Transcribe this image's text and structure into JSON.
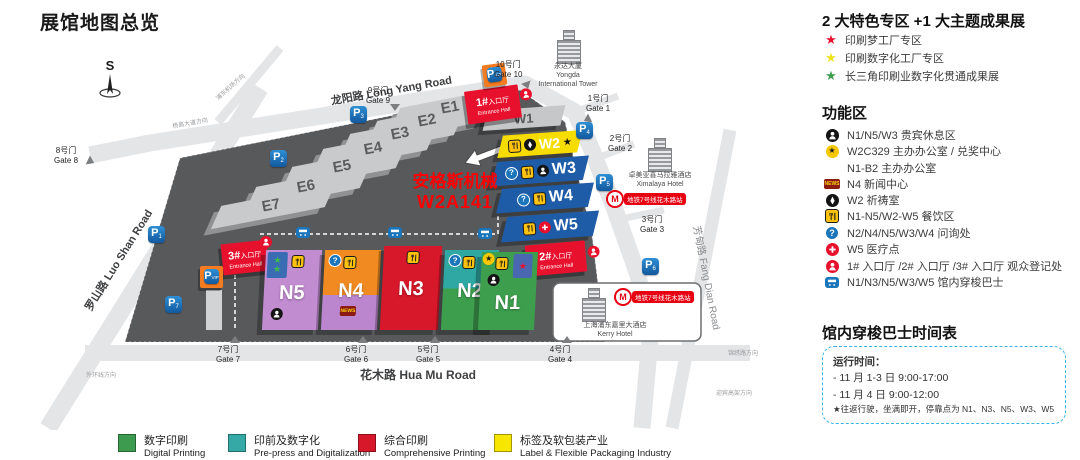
{
  "page_title": "展馆地图总览",
  "icons": {
    "news_text": "NEWS",
    "star_glyph": "★",
    "question_glyph": "?"
  },
  "colors": {
    "digital_green": "#3D9B4F",
    "prepress_teal": "#35A9A5",
    "comprehensive_red": "#D7182A",
    "label_yellow": "#F7E600",
    "entrance_red": "#E8112D",
    "w_hall_blue": "#1E5CA8",
    "w2_yellow": "#F7DC00",
    "n5_purple": "#C18CD0",
    "n4_orange": "#F08A21",
    "highlight_red": "#FF0000",
    "parking_blue": "#1B75BB",
    "vip_orange": "#F47B20",
    "metro_red": "#E60012"
  },
  "map": {
    "compass": "S",
    "roads": {
      "long_yang": "龙阳路 Long Yang Road",
      "luo_shan": "罗山路 Luo Shan Road",
      "hua_mu": "花木路 Hua Mu Road",
      "fang_dian": "芳甸路 Fang Dian Road"
    },
    "directions": {
      "airport": "浦东机场方向",
      "yanggao": "杨高大道方向",
      "waihuan": "外环线方向",
      "jinxiu": "锦绣路方向",
      "yingbin": "迎宾高架方向"
    },
    "halls": {
      "e": [
        "E1",
        "E2",
        "E3",
        "E4",
        "E5",
        "E6",
        "E7"
      ],
      "w": [
        "W1",
        "W2",
        "W3",
        "W4",
        "W5"
      ],
      "n": [
        "N5",
        "N4",
        "N3",
        "N2",
        "N1"
      ]
    },
    "entrances": [
      {
        "no": "1#",
        "cn": "入口厅",
        "en": "Entrance Hall"
      },
      {
        "no": "2#",
        "cn": "入口厅",
        "en": "Entrance Hall"
      },
      {
        "no": "3#",
        "cn": "入口厅",
        "en": "Entrance Hall"
      }
    ],
    "gates": [
      {
        "cn": "1号门",
        "en": "Gate 1"
      },
      {
        "cn": "2号门",
        "en": "Gate 2"
      },
      {
        "cn": "3号门",
        "en": "Gate 3"
      },
      {
        "cn": "4号门",
        "en": "Gate 4"
      },
      {
        "cn": "5号门",
        "en": "Gate 5"
      },
      {
        "cn": "6号门",
        "en": "Gate 6"
      },
      {
        "cn": "7号门",
        "en": "Gate 7"
      },
      {
        "cn": "8号门",
        "en": "Gate 8"
      },
      {
        "cn": "9号门",
        "en": "Gate 9"
      },
      {
        "cn": "10号门",
        "en": "Gate 10"
      }
    ],
    "parking": {
      "p": "P",
      "vip": "VIP",
      "nums": [
        "1",
        "2",
        "3",
        "4",
        "5",
        "6",
        "7"
      ]
    },
    "buildings": {
      "yongda_cn": "永达大厦",
      "yongda_en1": "Yongda",
      "yongda_en2": "International Tower",
      "ximalaya_cn": "卓美亚喜马拉雅酒店",
      "ximalaya_en": "Ximalaya Hotel",
      "kerry_cn": "上海浦东嘉里大酒店",
      "kerry_en": "Kerry Hotel"
    },
    "metro_label": "地铁7号线花木路站",
    "metro_logo": "M",
    "callout": {
      "line1": "安格斯机械",
      "line2": "W2A141"
    }
  },
  "panel": {
    "special_title": "2 大特色专区 +1 大主题成果展",
    "special_items": [
      {
        "color": "#E8112D",
        "label": "印刷梦工厂专区"
      },
      {
        "color": "#EDE21B",
        "label": "印刷数字化工厂专区"
      },
      {
        "color": "#3D9B4F",
        "label": "长三角印刷业数字化贯通成果展"
      }
    ],
    "function_title": "功能区",
    "function_items": [
      {
        "icon": "person",
        "label": "N1/N5/W3 贵宾休息区"
      },
      {
        "icon": "star",
        "label": "W2C329 主办办公室 / 兑奖中心"
      },
      {
        "icon": "none",
        "label": "N1-B2 主办办公室"
      },
      {
        "icon": "news",
        "label": "N4 新闻中心"
      },
      {
        "icon": "prayer",
        "label": "W2 祈祷室"
      },
      {
        "icon": "food",
        "label": "N1-N5/W2-W5 餐饮区"
      },
      {
        "icon": "question",
        "label": "N2/N4/N5/W3/W4 问询处"
      },
      {
        "icon": "medical",
        "label": "W5 医疗点"
      },
      {
        "icon": "entrance",
        "label": "1# 入口厅 /2# 入口厅 /3# 入口厅 观众登记处"
      },
      {
        "icon": "bus",
        "label": "N1/N3/N5/W3/W5 馆内穿梭巴士"
      }
    ],
    "bus_title": "馆内穿梭巴士时间表",
    "bus_box": {
      "heading": "运行时间：",
      "line1": "- 11 月 1-3 日 9:00-17:00",
      "line2": "- 11 月 4 日 9:00-12:00",
      "note": "★往返行驶，坐满即开，停靠点为 N1、N3、N5、W3、W5"
    }
  },
  "legend": [
    {
      "color": "#3D9B4F",
      "cn": "数字印刷",
      "en": "Digital Printing"
    },
    {
      "color": "#35A9A5",
      "cn": "印前及数字化",
      "en": "Pre-press and Digitalization"
    },
    {
      "color": "#D7182A",
      "cn": "综合印刷",
      "en": "Comprehensive Printing"
    },
    {
      "color": "#F7E600",
      "cn": "标签及软包装产业",
      "en": "Label & Flexible Packaging Industry"
    }
  ]
}
